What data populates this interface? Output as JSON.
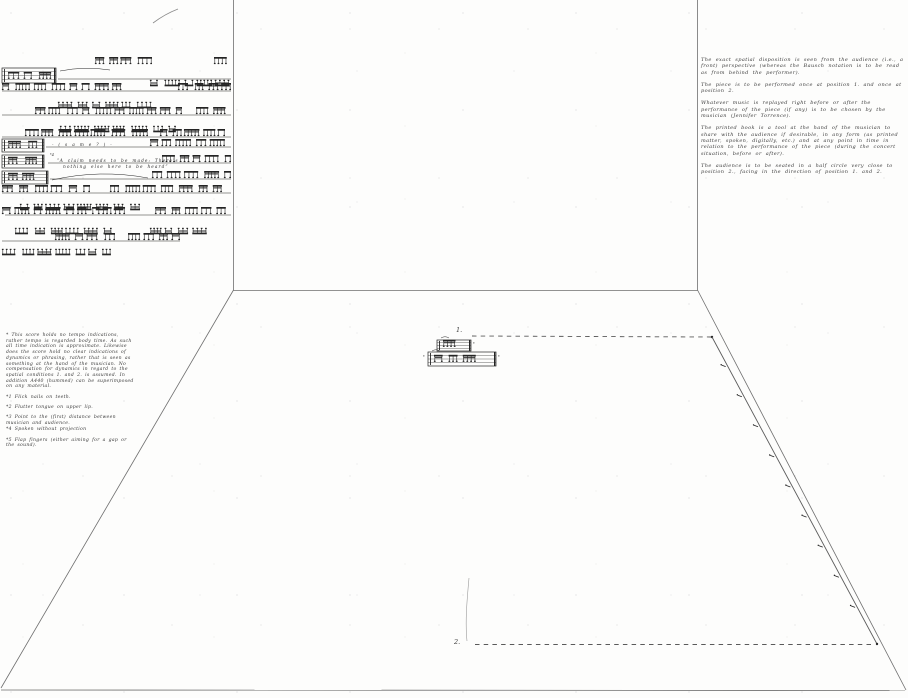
{
  "room": {
    "position1_label": "1.",
    "position2_label": "2."
  },
  "score": {
    "same_text": "- (  s  a  m  e  ?  ) -",
    "claim_marker": "*4",
    "claim_line1": "“A  claim  needs  to  be  made:  There’s",
    "claim_line2": "nothing  else  here  to  be  heard”"
  },
  "fragments": {
    "marks": [
      "*",
      "*",
      "*"
    ]
  },
  "footnotes": {
    "items": [
      "* This score holds no tempo indications, rather tempo is regarded body time. As such all time indication is approximate. Likewise does the score hold no clear indications of dynamics or phrasing, rather that is seen as something at the hand of the musician. No compensation for dynamics in regard to the spatial conditions 1. and 2. is assumed. In addition A440 (hummed) can be superimposed on any material.",
      "*1 Flick nails on teeth.",
      "*2 Flutter tongue on upper lip.",
      "*3 Point to the (first) distance between musician and audience.",
      "*4 Spoken without projection",
      "*5 Flap fingers (either aiming for a gap or the sound)."
    ]
  },
  "right_notes": {
    "paragraphs": [
      "The exact spatial disposition is seen from the audience (i.e., a front) perspective (whereas the Bausch notation is to be read as from behind the performer).",
      "The piece is to be performed once at position 1. and once at position 2.",
      "Whatever music is replayed right before or after the performance of the piece (if any) is to be chosen by the musician (Jennifer Torrence).",
      "The printed book is a tool at the hand of the musician to share with the audience if desirable, in any form (as printed matter, spoken, digitally, etc.) and at any point in time in relation to the performance of the piece (during the concert situation, before or after).",
      "The audience is to be seated in a half circle very close to position 2., facing in the direction of position 1. and 2."
    ]
  },
  "colors": {
    "ink": "#242424",
    "line": "#6e6e6e",
    "faint": "#9a9a9a"
  }
}
